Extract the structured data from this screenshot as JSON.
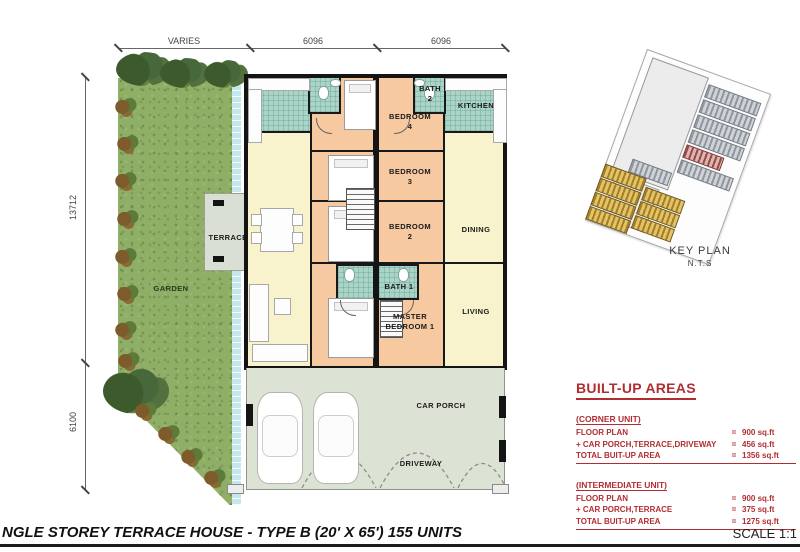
{
  "colors": {
    "accent_red": "#b22d32",
    "wall_black": "#141414",
    "grass_green": "#8fae66",
    "tile_teal": "#a9d5c8",
    "bedroom_peach": "#f6c9a1",
    "living_cream": "#f8f3cd",
    "porch_grey": "#dde3d4",
    "drain_blue": "#c4e7ec",
    "keyplan_gold": "#a57f22",
    "keyplan_grey": "#8f969e"
  },
  "dims": {
    "top": [
      "VARIES",
      "6096",
      "6096"
    ],
    "left_upper": "13712",
    "left_lower": "6100"
  },
  "rooms": {
    "garden": "GARDEN",
    "terrace": "TERRACE",
    "bedroom4": "BEDROOM\n4",
    "bath2": "BATH\n2",
    "kitchen": "KITCHEN",
    "bedroom3": "BEDROOM\n3",
    "bedroom2": "BEDROOM\n2",
    "dining": "DINING",
    "bath1": "BATH 1",
    "master": "MASTER\nBEDROOM 1",
    "living": "LIVING",
    "carporch": "CAR PORCH",
    "driveway": "DRIVEWAY"
  },
  "key_plan": {
    "title": "KEY PLAN",
    "subtitle": "N.T.S"
  },
  "built_up": {
    "heading": "BUILT-UP AREAS",
    "sections": [
      {
        "header": "(CORNER UNIT)",
        "rows": [
          {
            "label": "FLOOR PLAN",
            "eq": "=",
            "value": "900 sq.ft"
          },
          {
            "label": "+ CAR PORCH,TERRACE,DRIVEWAY",
            "eq": "=",
            "value": "456 sq.ft"
          }
        ],
        "total": {
          "label": "TOTAL BUIT-UP AREA",
          "eq": "=",
          "value": "1356 sq.ft"
        }
      },
      {
        "header": "(INTERMEDIATE UNIT)",
        "rows": [
          {
            "label": "FLOOR PLAN",
            "eq": "=",
            "value": "900 sq.ft"
          },
          {
            "label": "+ CAR PORCH,TERRACE",
            "eq": "=",
            "value": "375 sq.ft"
          }
        ],
        "total": {
          "label": "TOTAL BUIT-UP AREA",
          "eq": "=",
          "value": "1275 sq.ft"
        }
      }
    ]
  },
  "title_block": {
    "title": "NGLE STOREY TERRACE HOUSE - TYPE B (20' X 65') 155 UNITS",
    "scale": "SCALE 1:1"
  }
}
